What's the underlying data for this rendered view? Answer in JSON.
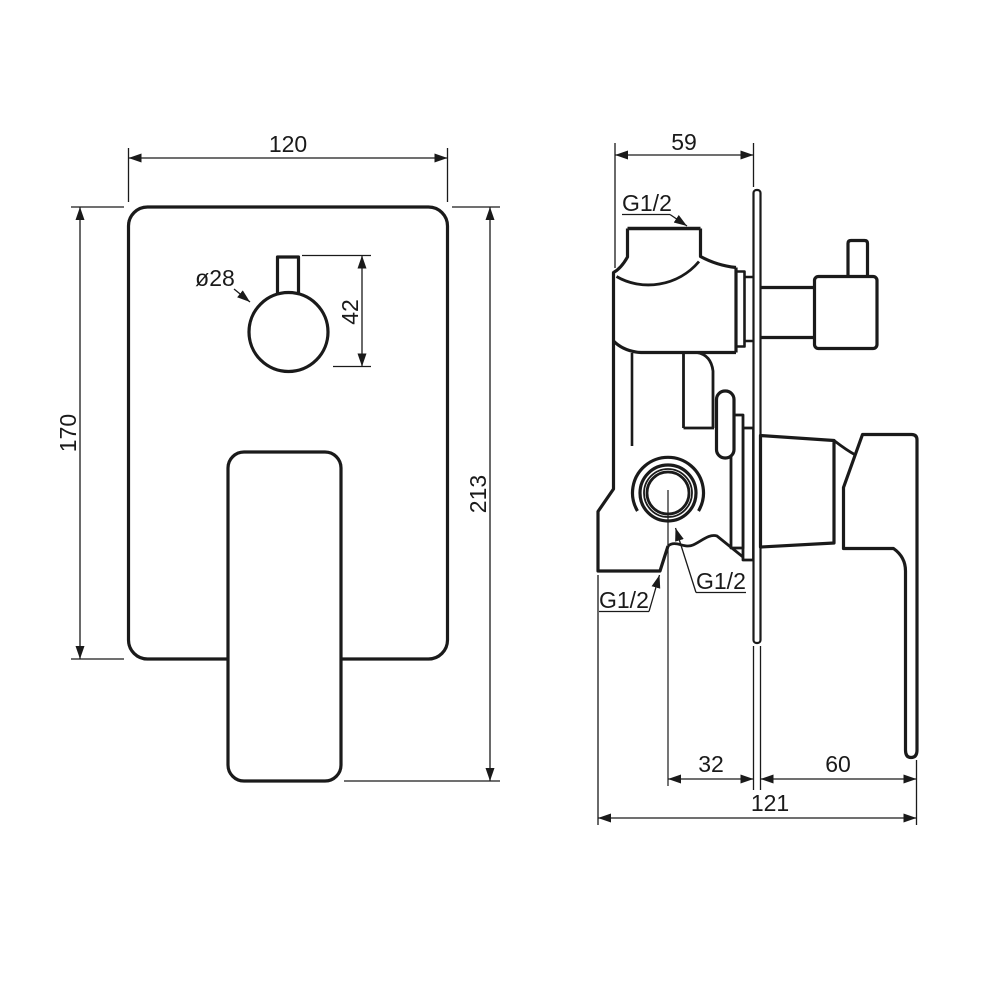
{
  "front": {
    "width": "120",
    "height": "170",
    "total_height": "213",
    "knob_diameter": "ø28",
    "knob_height": "42"
  },
  "side": {
    "depth": "59",
    "port_offset": "32",
    "handle_depth": "60",
    "total_depth": "121",
    "thread_top": "G1/2",
    "thread_side": "G1/2",
    "thread_bottom": "G1/2"
  },
  "colors": {
    "line": "#1a1a1a",
    "background": "#ffffff"
  }
}
